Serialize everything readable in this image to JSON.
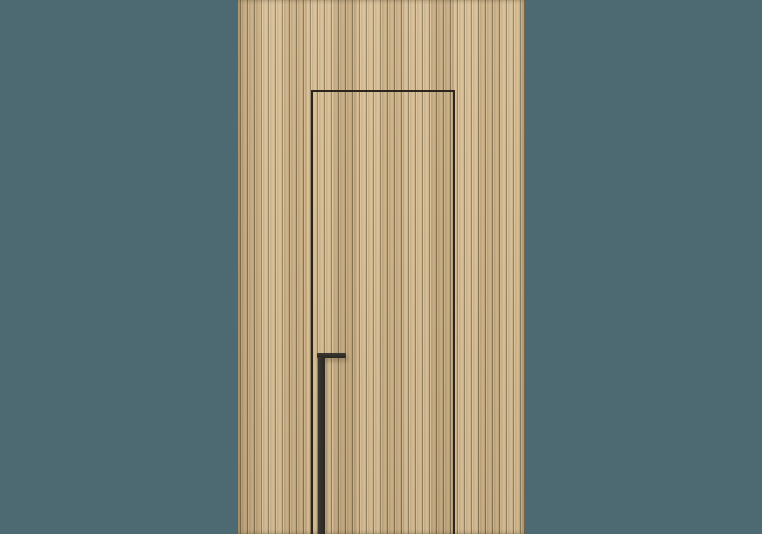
{
  "scene": {
    "type": "product-render",
    "subject": "Concealed flush interior door set into a full-height vertical wood slat wall panel, with a matte black L-shaped edge-pull handle whose stem runs to the floor",
    "text_content": "none",
    "colors": {
      "background": "#4d6a73",
      "wood_base": "#cdb288",
      "wood_light": "#d4ba90",
      "wood_mid": "#c9ae83",
      "wood_shade": "#b29870",
      "wood_groove": "#8b7856",
      "door_outline": "#2b251d",
      "handle_dark": "#2a2621",
      "handle_light": "#3b3731"
    },
    "elements": [
      {
        "name": "scene-background",
        "description": "flat slate-teal backdrop filling the frame"
      },
      {
        "name": "wood-slat-wall-panel",
        "description": "centered full-height light-oak reeded slat panel"
      },
      {
        "name": "concealed-door-outline",
        "description": "thin dark reveal line forming a door rectangle open at the bottom edge"
      },
      {
        "name": "door-edge-pull-handle",
        "description": "matte black pull: short horizontal bar with vertical stem extending to bottom of frame"
      }
    ]
  }
}
